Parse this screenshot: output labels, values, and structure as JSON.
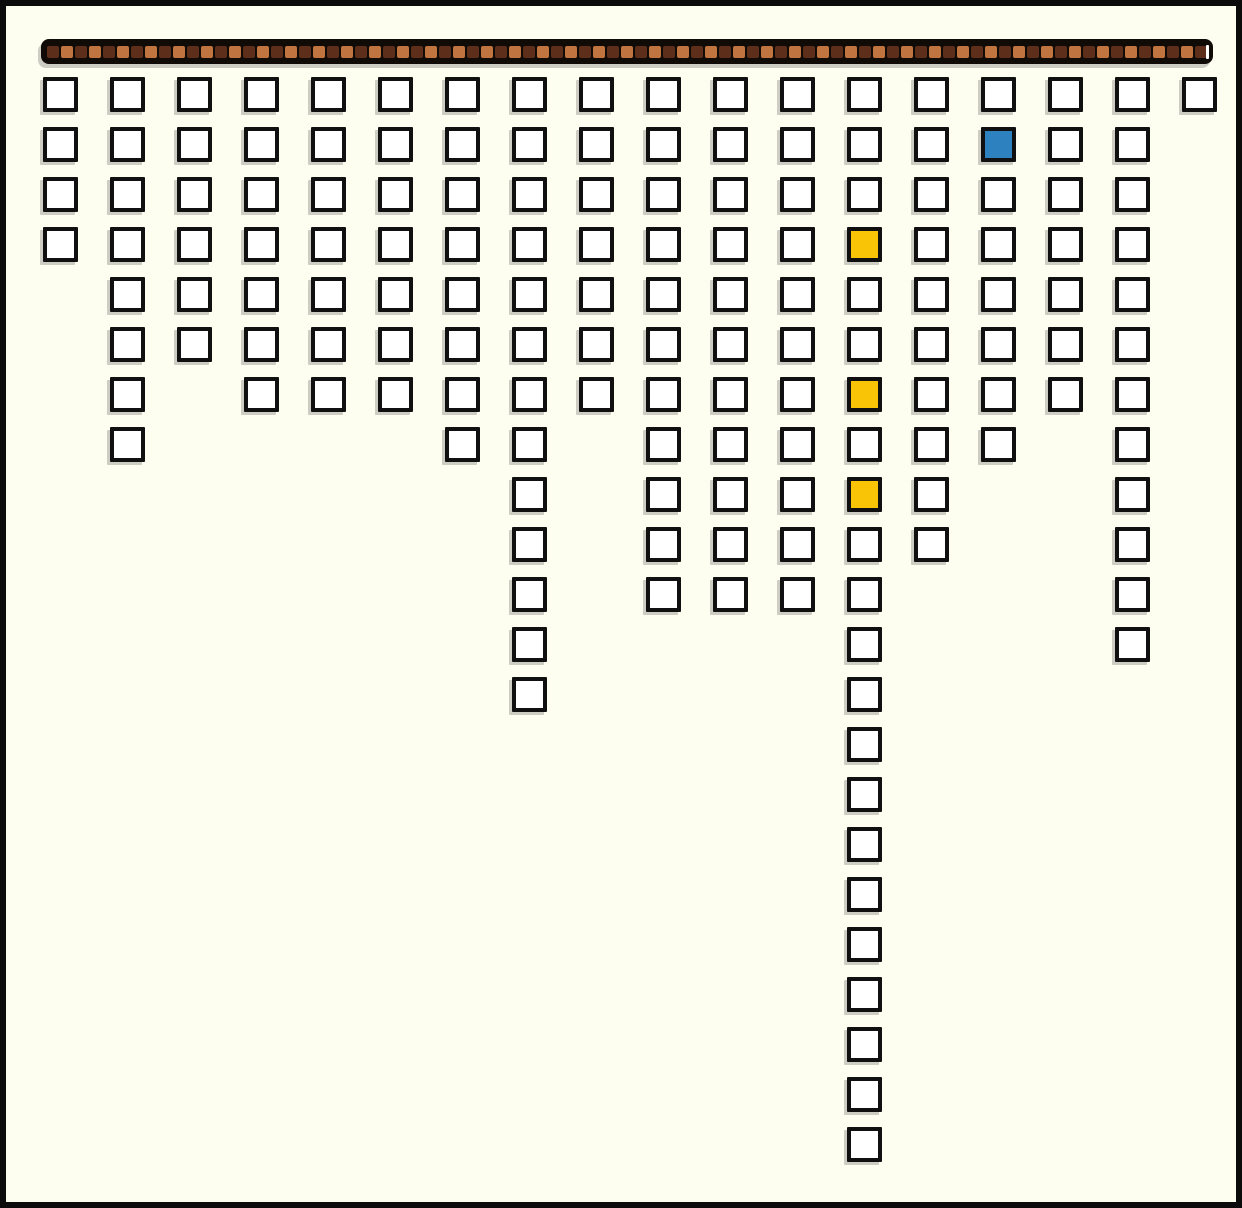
{
  "app": {
    "title": "block-drop-board",
    "description": "Grid of outlined cells hanging in columns from a segmented bar; three gold cells and one blue cell highlighted. No visible text in UI."
  },
  "canvas": {
    "width": 1242,
    "height": 1208,
    "background_color": "#FDFDF0",
    "frame_color": "#0B0B0B",
    "frame_thickness": 6
  },
  "top_bar": {
    "x": 35,
    "y": 33,
    "width": 1172,
    "height": 25,
    "background_color": "#100B07",
    "segment_count": 83,
    "segment_size": 12,
    "segment_gap": 2,
    "segment_color_dark": "#5D2F1B",
    "segment_color_light": "#C0743F",
    "end_notch_color": "#FFFFFF"
  },
  "grid": {
    "columns": 18,
    "max_rows": 22,
    "origin_x": 37,
    "origin_y": 71,
    "col_pitch": 67,
    "row_pitch": 50,
    "cell_size": 35,
    "cell_border_px": 4,
    "cell_fill_color": "#FFFFFF",
    "cell_border_color": "#101010",
    "column_heights": [
      4,
      8,
      6,
      7,
      7,
      7,
      8,
      13,
      7,
      11,
      11,
      11,
      22,
      10,
      8,
      7,
      12,
      1
    ],
    "highlight_cells": [
      {
        "column": 15,
        "row": 2,
        "color": "#2E81BF",
        "name": "blue"
      },
      {
        "column": 13,
        "row": 4,
        "color": "#F9C306",
        "name": "yellow"
      },
      {
        "column": 13,
        "row": 7,
        "color": "#F9C306",
        "name": "yellow"
      },
      {
        "column": 13,
        "row": 9,
        "color": "#F9C306",
        "name": "yellow"
      }
    ]
  }
}
